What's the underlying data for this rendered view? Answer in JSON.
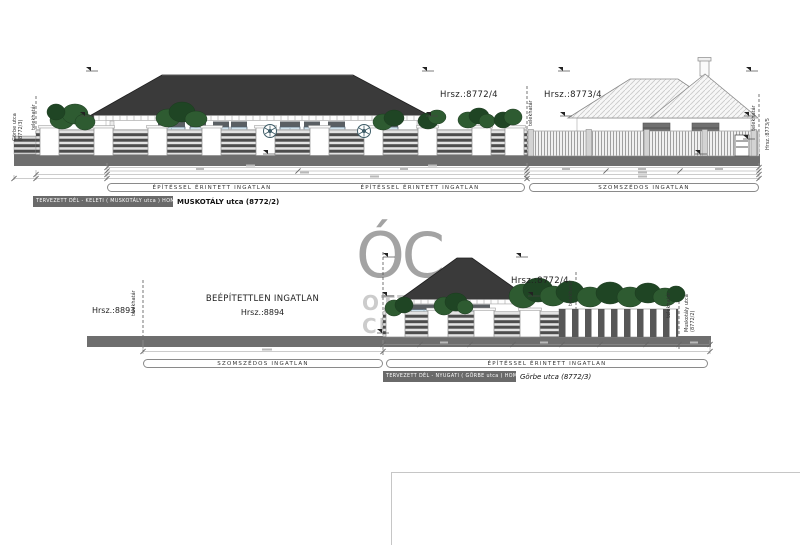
{
  "shared": {
    "boundary_label": "telekhatár",
    "zone_affected": "ÉPÍTÉSSEL ÉRINTETT INGATLAN",
    "zone_neighbor": "SZOMSZÉDOS INGATLAN"
  },
  "watermark": {
    "logo": "ÓC",
    "line1": "OTTHON",
    "line2": "CENTRUM"
  },
  "top": {
    "street_left_line1": "Görbe utca",
    "street_left_line2": "(8772/3)",
    "parcel_main": "Hrsz.:8772/4",
    "parcel_neighbor": "Hrsz.:8773/4",
    "parcel_far_right": "Hrsz.:8773/5",
    "badge": "TERVEZETT DÉL - KELETI ( MUSKOTÁLY utca ) HOMLOKZAT",
    "street_ref": "MUSKOTÁLY utca (8772/2)"
  },
  "bottom": {
    "parcel_left": "Hrsz.:8893",
    "empty_lot_title": "BEÉPÍTETTLEN INGATLAN",
    "empty_lot_parcel": "Hrsz.:8894",
    "parcel_main": "Hrsz.:8772/4",
    "street_right_line1": "Muskotály utca",
    "street_right_line2": "(8772/2)",
    "badge": "TERVEZETT DÉL - NYUGATI ( GÖRBE utca ) HOMLOKZAT",
    "street_ref": "Görbe utca (8772/3)"
  },
  "colors": {
    "ground": "#6e6e6e",
    "roof_dark": "#3a3a3a",
    "badge_bg": "#6a6a6a",
    "greenery": "#2e5b31",
    "window_glass": "#cfe2ed",
    "watermark": "#a3a3a3"
  }
}
